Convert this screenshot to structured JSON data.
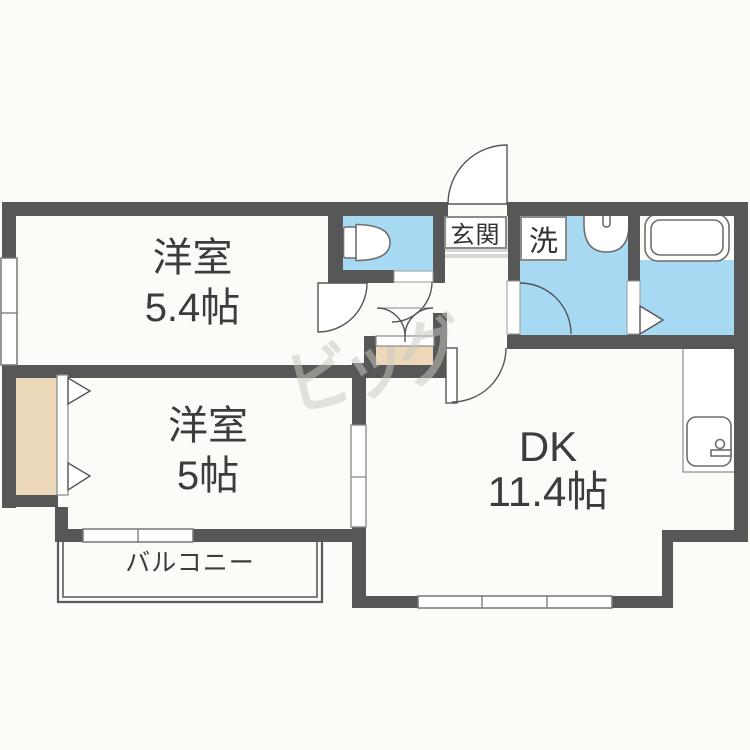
{
  "floorplan": {
    "rooms": {
      "room1": {
        "label": "洋室",
        "size": "5.4帖"
      },
      "room2": {
        "label": "洋室",
        "size": "5帖"
      },
      "dk": {
        "label": "DK",
        "size": "11.4帖"
      },
      "balcony": {
        "label": "バルコニー"
      },
      "entrance": {
        "label": "玄関"
      },
      "laundry": {
        "label": "洗"
      }
    },
    "fixtures": {
      "toilet": "toilet-icon",
      "washbasin": "washbasin-icon",
      "bathtub": "bathtub-icon",
      "kitchen_sink": "kitchen-sink-icon"
    },
    "watermark": {
      "text": "ビッグ"
    },
    "colors": {
      "wall": "#575757",
      "water_blue": "#a8d9f2",
      "closet_tan": "#ecd9ba",
      "genkan_gray": "#d6d6d4",
      "text": "#3c3c3c"
    }
  }
}
